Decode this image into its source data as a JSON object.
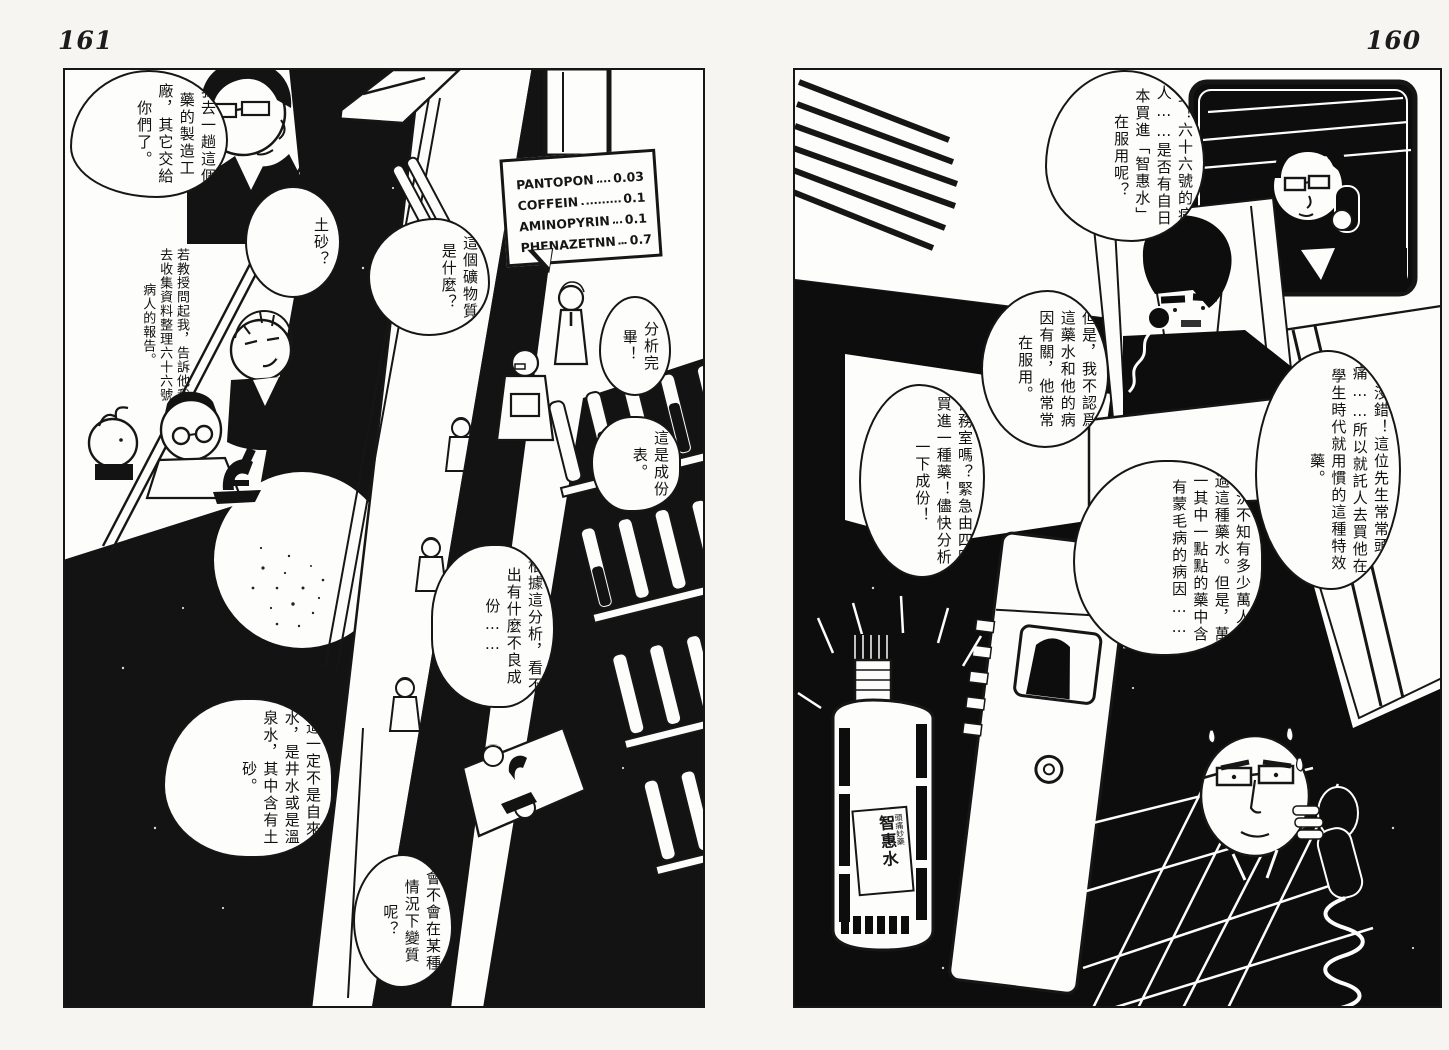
{
  "spread": {
    "left_page_number": "161",
    "right_page_number": "160"
  },
  "pages": {
    "left": {
      "page_number": "161",
      "sign": {
        "rows": [
          {
            "name": "PANTOPON",
            "value": "0.03"
          },
          {
            "name": "COFFEIN",
            "value": "0.1"
          },
          {
            "name": "AMINOPYRIN",
            "value": "0.1"
          },
          {
            "name": "PHENAZETNN",
            "value": "0.7"
          }
        ]
      },
      "bubbles": {
        "factory": "我去一趟這個藥的製造工廠，其它交給你們了。",
        "professor": "若教授問起我，告訴他我去收集資料整理六十六號病人的報告。",
        "sand": "土砂？",
        "mineral": "這個礦物質是什麼？",
        "analysis_done": "分析完畢！",
        "composition": "這是成份表。",
        "no_defect": "根據這分析，看不出有什麼不良成份……",
        "water": "這一定不是自來水，是井水或是溫泉水，其中含有土砂。",
        "change": "會不會在某種情況下變質呢？"
      }
    },
    "right": {
      "page_number": "160",
      "bubbles": {
        "patient": "對！六十六號的病人……是否有自日本買進「智惠水」在服用呢？",
        "doubt": "但是，我不認爲這藥水和他的病因有關，他常常在服用。",
        "headache": "沒錯！這位先生常常頭痛……所以就託人去買他在學生時代就用慣的這種特效藥。",
        "millions": "何況不知有多少萬人喝過這種藥水。但是，萬一其中一點點的藥中含有蒙毛病的病因……",
        "clinic": "醫務室嗎？緊急由四國買進一種藥！儘快分析一下成份！"
      },
      "bottle": {
        "label": "智惠水",
        "sub_label": "頭痛妙藥"
      }
    }
  }
}
